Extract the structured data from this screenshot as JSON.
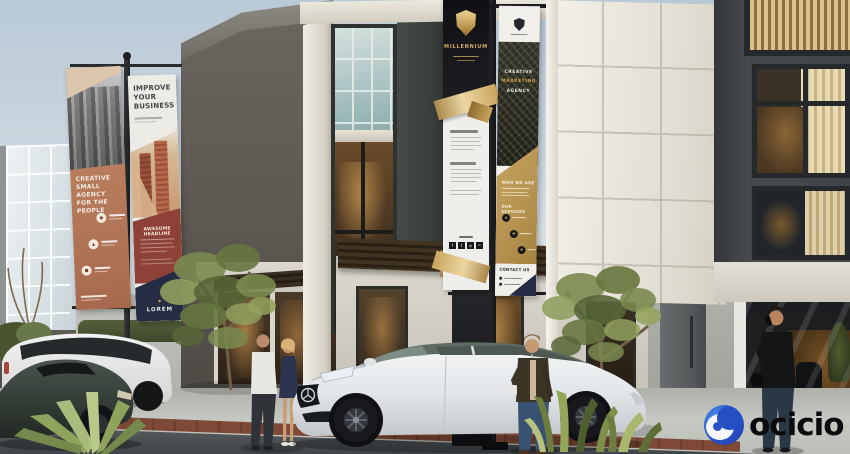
{
  "watermark": {
    "brand": "ocicio"
  },
  "banner_agency": {
    "title_line1": "CREATIVE",
    "title_line2": "SMALL AGENCY",
    "title_line3": "FOR THE PEOPLE",
    "icons": [
      {
        "name": "feature-icon-1",
        "glyph": "●"
      },
      {
        "name": "feature-icon-2",
        "glyph": "▲"
      },
      {
        "name": "feature-icon-3",
        "glyph": "■"
      }
    ]
  },
  "banner_improve": {
    "title_line1": "IMPROVE",
    "title_line2": "YOUR",
    "title_line3": "BUSINESS",
    "ribbon": "AWESOME HEADLINE",
    "brand": "LOREM"
  },
  "banner_millennium": {
    "brand": "MILLENNIUM",
    "social": [
      {
        "name": "facebook-icon",
        "glyph": "f"
      },
      {
        "name": "twitter-icon",
        "glyph": "t"
      },
      {
        "name": "instagram-icon",
        "glyph": "◎"
      },
      {
        "name": "linkedin-icon",
        "glyph": "in"
      }
    ]
  },
  "banner_marketing": {
    "title_line1": "CREATIVE",
    "title_line2": "MARKETING",
    "title_line3": "AGENCY",
    "section_who": "WHO WE ARE",
    "section_services": "OUR SERVICES",
    "section_contact": "CONTACT US",
    "services": [
      {
        "name": "service-icon-1",
        "glyph": "★"
      },
      {
        "name": "service-icon-2",
        "glyph": "✚"
      },
      {
        "name": "service-icon-3",
        "glyph": "♦"
      }
    ]
  },
  "palette": {
    "gold": "#c8a15c",
    "navy": "#272e44",
    "maroon": "#8e4136",
    "tan": "#bc835f",
    "black_banner": "#17171b",
    "watermark_blue": "#2b55d4"
  }
}
